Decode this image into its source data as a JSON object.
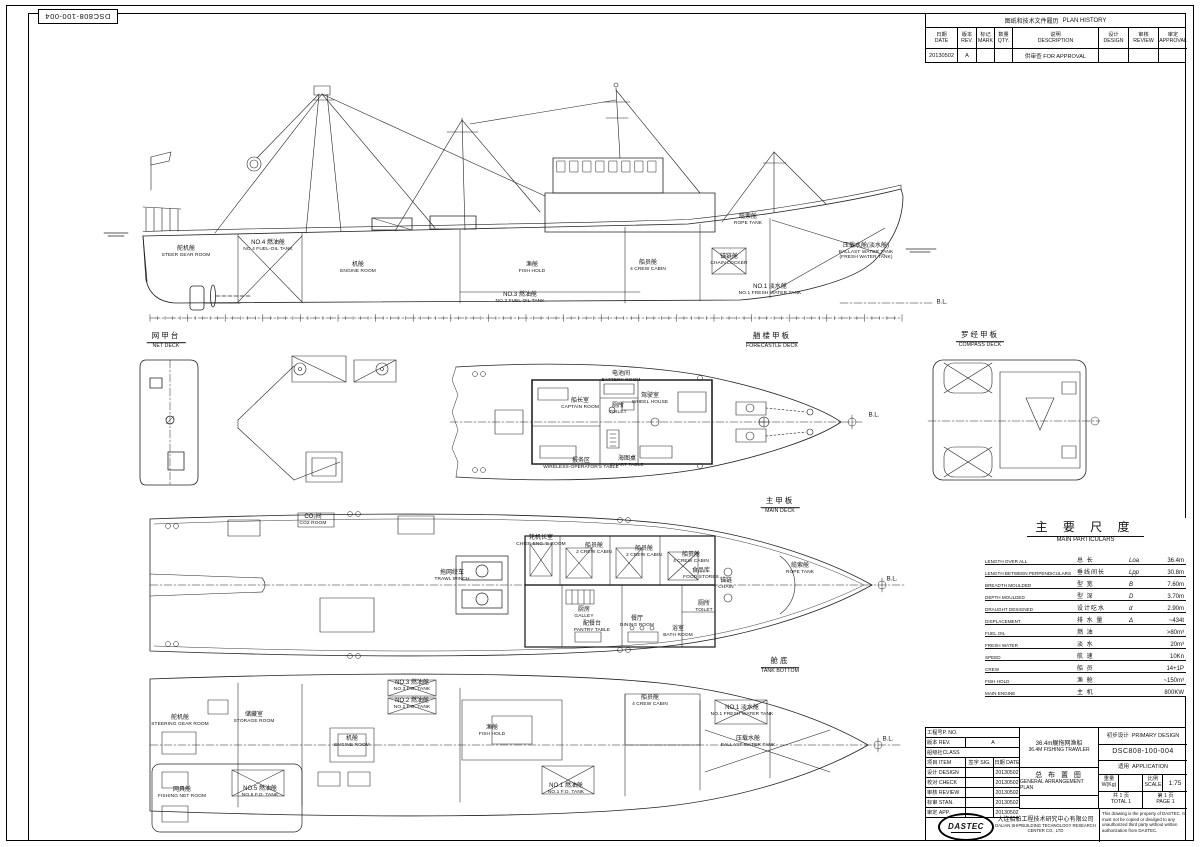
{
  "doc_number": "DSC808-100-004",
  "plan_history": {
    "title_cn": "图纸和技术文件履历",
    "title_en": "PLAN HISTORY",
    "columns": [
      {
        "cn": "日期",
        "en": "DATE"
      },
      {
        "cn": "版本",
        "en": "REV."
      },
      {
        "cn": "标记",
        "en": "MARK"
      },
      {
        "cn": "数量",
        "en": "QTY."
      },
      {
        "cn": "说明",
        "en": "DESCRIPTION"
      },
      {
        "cn": "设计",
        "en": "DESIGN"
      },
      {
        "cn": "审核",
        "en": "REVIEW"
      },
      {
        "cn": "审定",
        "en": "APPROVAL"
      }
    ],
    "rows": [
      [
        "20130502",
        "A",
        "",
        "",
        "供审查  FOR APPROVAL",
        "",
        "",
        ""
      ]
    ]
  },
  "main_particulars": {
    "title_cn": "主 要 尺 度",
    "title_en": "MAIN PARTICULARS",
    "rows": [
      {
        "en": "LENGTH OVER ALL",
        "cn": "总    长",
        "sym": "Loa",
        "val": "36.4m"
      },
      {
        "en": "LENGTH BETWEEN PERPENDICULARS",
        "cn": "垂线间长",
        "sym": "Lpp",
        "val": "30.8m"
      },
      {
        "en": "BREADTH MOULDED",
        "cn": "型    宽",
        "sym": "B",
        "val": "7.60m"
      },
      {
        "en": "DEPTH MOULDED",
        "cn": "型    深",
        "sym": "D",
        "val": "3.70m"
      },
      {
        "en": "DRAUGHT DESIGNED",
        "cn": "设计吃水",
        "sym": "d",
        "val": "2.90m"
      },
      {
        "en": "DISPLACEMENT",
        "cn": "排 水 量",
        "sym": "Δ",
        "val": "~434t"
      },
      {
        "en": "FUEL OIL",
        "cn": "燃    油",
        "sym": "",
        "val": ">80m³"
      },
      {
        "en": "FRESH WATER",
        "cn": "淡    水",
        "sym": "",
        "val": "20m³"
      },
      {
        "en": "SPEED",
        "cn": "航    速",
        "sym": "",
        "val": "10Kn"
      },
      {
        "en": "CREW",
        "cn": "船    员",
        "sym": "",
        "val": "14+1P"
      },
      {
        "en": "FISH HOLD",
        "cn": "渔    舱",
        "sym": "",
        "val": "~150m³"
      },
      {
        "en": "MAIN ENGINE",
        "cn": "主    机",
        "sym": "",
        "val": "800KW"
      }
    ]
  },
  "title_block": {
    "left_rows": [
      {
        "label": "工程号P. NO.",
        "mid": "",
        "date": "",
        "span": true
      },
      {
        "label": "版本 REV.",
        "mid": "A",
        "date": "",
        "wide_mid": true
      },
      {
        "label": "船级社CLASS",
        "mid": "",
        "date": "",
        "span": true
      },
      {
        "label": "项目 ITEM",
        "mid": "签字 SIG.",
        "date": "日期 DATE"
      },
      {
        "label": "设计 DESIGN",
        "mid": "",
        "date": "20130502"
      },
      {
        "label": "校对 CHECK",
        "mid": "",
        "date": "20130502"
      },
      {
        "label": "审核 REVIEW",
        "mid": "",
        "date": "20130502"
      },
      {
        "label": "标审 STAN.",
        "mid": "",
        "date": "20130502"
      },
      {
        "label": "审定 APP.",
        "mid": "",
        "date": "20130502"
      }
    ],
    "ship_name_cn": "36.4m艉拖网渔船",
    "ship_name_en": "36.4M FISHING TRAWLER",
    "drawing_title_cn": "总 布 置 图",
    "drawing_title_en": "GENERAL ARRANGEMENT PLAN",
    "design_stage_cn": "初步设计",
    "design_stage_en": "PRIMARY DESIGN",
    "drawing_no": "DSC808-100-004",
    "application_cn": "适用",
    "application_en": "APPLICATION",
    "weight_label_cn": "重量",
    "weight_label_en": "W(Kg)",
    "weight_value": "",
    "scale_label_cn": "比例",
    "scale_label_en": "SCALE",
    "scale_value": "1:75",
    "total_cn": "共 1 页",
    "total_en": "TOTAL 1",
    "page_cn": "第 1 页",
    "page_en": "PAGE 1",
    "logo_text": "DASTEC",
    "company_cn": "大连船舶工程技术研究中心有限公司",
    "company_en": "DALIAN SHIPBUILDING TECHNOLOGY RESEARCH CENTER CO., LTD",
    "property_note": "This drawing is the property of DASTEC. It must not be copied or divulged to any unauthorized third party without written authorization from DASTEC."
  },
  "drawing_labels": [
    {
      "name": "label-steer-gear-room",
      "x": 186,
      "y": 252,
      "cn": "舵机舱",
      "en": "STEER GEAR ROOM"
    },
    {
      "name": "label-no4-fuel-oil-tank",
      "x": 268,
      "y": 246,
      "cn": "NO.4 燃油舱",
      "en": "NO.4 FUEL-OIL TANK"
    },
    {
      "name": "label-engine-room-profile",
      "x": 358,
      "y": 268,
      "cn": "机舱",
      "en": "ENGINE ROOM"
    },
    {
      "name": "label-fish-hold-profile",
      "x": 532,
      "y": 268,
      "cn": "渔舱",
      "en": "FISH HOLD"
    },
    {
      "name": "label-crew-cabin-profile",
      "x": 648,
      "y": 266,
      "cn": "船员舱",
      "en": "4 CREW CABIN"
    },
    {
      "name": "label-rope-tank-profile",
      "x": 748,
      "y": 220,
      "cn": "缆索舱",
      "en": "ROPE TANK"
    },
    {
      "name": "label-ballast-tank-profile",
      "x": 866,
      "y": 252,
      "cn": "压载水舱(淡水舱)",
      "en": "BALLAST WATER TANK (FRESH WATER TANK)",
      "wrap": true
    },
    {
      "name": "label-chain-locker-profile",
      "x": 729,
      "y": 260,
      "cn": "锚链舱",
      "en": "CHAIN LOCKER"
    },
    {
      "name": "label-no1-fresh-water-tank-profile",
      "x": 770,
      "y": 290,
      "cn": "NO.1 淡水舱",
      "en": "NO.1 FRESH WATER TANK"
    },
    {
      "name": "label-no3-fuel-oil-tank-profile",
      "x": 520,
      "y": 298,
      "cn": "NO.3 燃油舱",
      "en": "NO.3 FUEL OIL TANK"
    },
    {
      "name": "label-baseline-mark-profile",
      "x": 942,
      "y": 303,
      "cn": "B.L.",
      "en": "",
      "mark": true
    },
    {
      "name": "view-title-net-deck",
      "x": 166,
      "y": 341,
      "cn": "网甲台",
      "en": "NET DECK",
      "title": true
    },
    {
      "name": "view-title-forecastle-deck",
      "x": 772,
      "y": 341,
      "cn": "艏楼甲板",
      "en": "FORECASTLE DECK",
      "title": true
    },
    {
      "name": "view-title-compass-deck",
      "x": 980,
      "y": 340,
      "cn": "罗经甲板",
      "en": "COMPASS DECK",
      "title": true
    },
    {
      "name": "view-title-main-deck",
      "x": 780,
      "y": 506,
      "cn": "主甲板",
      "en": "MAIN DECK",
      "title": true
    },
    {
      "name": "view-title-tank-bottom",
      "x": 780,
      "y": 666,
      "cn": "舱底",
      "en": "TANK BOTTOM",
      "title": true
    },
    {
      "name": "label-battery-room",
      "x": 621,
      "y": 377,
      "cn": "电池间",
      "en": "BATTERY ROOM"
    },
    {
      "name": "label-captain-room",
      "x": 580,
      "y": 404,
      "cn": "船长室",
      "en": "CAPTAIN ROOM"
    },
    {
      "name": "label-toilet-forecastle",
      "x": 618,
      "y": 409,
      "cn": "厕所",
      "en": "TOILET"
    },
    {
      "name": "label-wheel-house",
      "x": 650,
      "y": 399,
      "cn": "驾驶室",
      "en": "WHEEL HOUSE"
    },
    {
      "name": "label-wireless-operators-table",
      "x": 581,
      "y": 464,
      "cn": "报务区",
      "en": "WIRELESS-OPERATOR'S TABLE"
    },
    {
      "name": "label-chart-table",
      "x": 627,
      "y": 462,
      "cn": "海图桌",
      "en": "CHART TABLE"
    },
    {
      "name": "label-centerline-mark-forecastle",
      "x": 874,
      "y": 416,
      "cn": "B.L.",
      "en": "",
      "mark": true
    },
    {
      "name": "label-co2-room",
      "x": 313,
      "y": 520,
      "cn": "CO₂间",
      "en": "CO2 ROOM"
    },
    {
      "name": "label-chief-eng-room",
      "x": 541,
      "y": 541,
      "cn": "轮机长室",
      "en": "CHIEF ENG.'S ROOM"
    },
    {
      "name": "label-crew-cabin-2a",
      "x": 594,
      "y": 549,
      "cn": "船员舱",
      "en": "2 CREW CABIN"
    },
    {
      "name": "label-crew-cabin-2b",
      "x": 644,
      "y": 552,
      "cn": "船员舱",
      "en": "2 CREW CABIN"
    },
    {
      "name": "label-crew-cabin-4-main",
      "x": 691,
      "y": 558,
      "cn": "船员舱",
      "en": "4 CREW CABIN"
    },
    {
      "name": "label-trawl-winch",
      "x": 452,
      "y": 576,
      "cn": "拖网绞车",
      "en": "TRAWL WINCH"
    },
    {
      "name": "label-galley",
      "x": 584,
      "y": 613,
      "cn": "厨房",
      "en": "GALLEY"
    },
    {
      "name": "label-pantry-table",
      "x": 592,
      "y": 627,
      "cn": "配餐台",
      "en": "PANTRY TABLE"
    },
    {
      "name": "label-dining-room",
      "x": 637,
      "y": 622,
      "cn": "餐厅",
      "en": "DINING ROOM"
    },
    {
      "name": "label-toilet-main-deck",
      "x": 704,
      "y": 607,
      "cn": "厕所",
      "en": "TOILET"
    },
    {
      "name": "label-bath-room",
      "x": 678,
      "y": 632,
      "cn": "浴室",
      "en": "BATH ROOM"
    },
    {
      "name": "label-food-stores",
      "x": 701,
      "y": 574,
      "cn": "食品库",
      "en": "FOOD STORES"
    },
    {
      "name": "label-chain-main-deck",
      "x": 726,
      "y": 584,
      "cn": "锚链",
      "en": "CHAIN"
    },
    {
      "name": "label-rope-tank-main-deck",
      "x": 800,
      "y": 569,
      "cn": "缆索舱",
      "en": "ROPE TANK"
    },
    {
      "name": "label-centerline-mark-main-deck",
      "x": 892,
      "y": 580,
      "cn": "B.L.",
      "en": "",
      "mark": true
    },
    {
      "name": "label-steering-gear-room-bottom",
      "x": 180,
      "y": 721,
      "cn": "舵机舱",
      "en": "STEERING GEAR ROOM"
    },
    {
      "name": "label-storage-room",
      "x": 254,
      "y": 718,
      "cn": "储藏室",
      "en": "STORAGE ROOM"
    },
    {
      "name": "label-engine-room-bottom",
      "x": 352,
      "y": 742,
      "cn": "机舱",
      "en": "ENGINE ROOM"
    },
    {
      "name": "label-no3-fo-tank-bottom",
      "x": 412,
      "y": 686,
      "cn": "NO.3 燃油舱",
      "en": "NO.3 F.O. TANK"
    },
    {
      "name": "label-no2-fo-tank-bottom",
      "x": 412,
      "y": 704,
      "cn": "NO.2 燃油舱",
      "en": "NO.2 F.O. TANK"
    },
    {
      "name": "label-fish-hold-bottom",
      "x": 492,
      "y": 731,
      "cn": "渔舱",
      "en": "FISH HOLD"
    },
    {
      "name": "label-no1-fo-tank-bottom",
      "x": 566,
      "y": 789,
      "cn": "NO.1 燃油舱",
      "en": "NO.1 F.O. TANK"
    },
    {
      "name": "label-crew-cabin-4-bottom",
      "x": 650,
      "y": 701,
      "cn": "船员舱",
      "en": "4 CREW CABIN"
    },
    {
      "name": "label-no1-fresh-water-tank-bottom",
      "x": 742,
      "y": 711,
      "cn": "NO.1 淡水舱",
      "en": "NO.1 FRESH WATER TANK"
    },
    {
      "name": "label-ballast-water-tank-bottom",
      "x": 748,
      "y": 742,
      "cn": "压载水舱",
      "en": "BALLAST WATER TANK"
    },
    {
      "name": "label-fishing-net-room",
      "x": 182,
      "y": 793,
      "cn": "网具舱",
      "en": "FISHING NET ROOM"
    },
    {
      "name": "label-no5-fo-tank",
      "x": 260,
      "y": 792,
      "cn": "NO.5 燃油舱",
      "en": "NO.5 F.O. TANK"
    },
    {
      "name": "label-centerline-mark-tank-bottom",
      "x": 888,
      "y": 740,
      "cn": "B.L.",
      "en": "",
      "mark": true
    }
  ]
}
